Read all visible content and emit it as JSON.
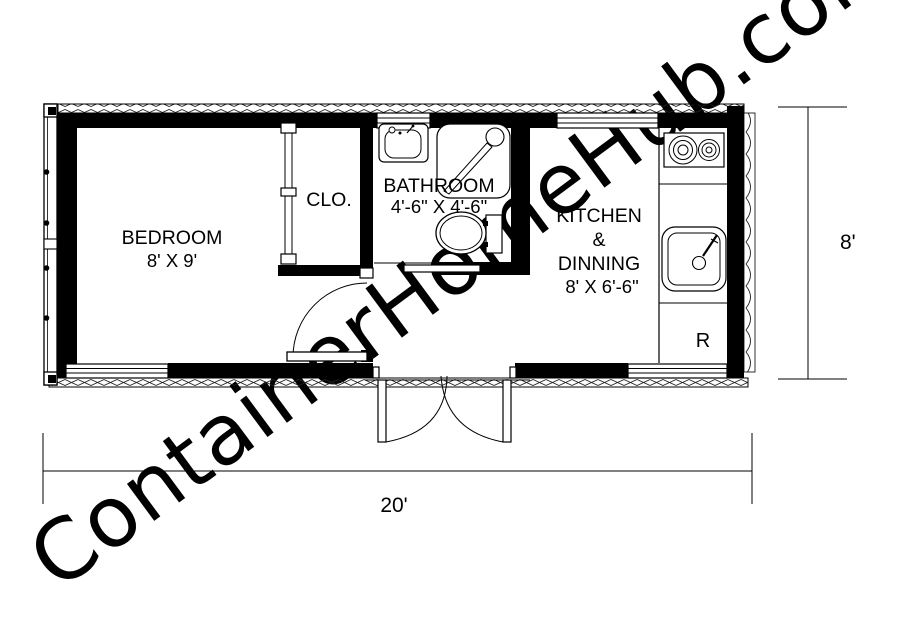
{
  "watermark": {
    "text": "ContainerHomeHub.com",
    "color": "#e3e3e3"
  },
  "rooms": {
    "bedroom": {
      "label": "BEDROOM",
      "size": "8' X 9'"
    },
    "closet": {
      "label": "CLO."
    },
    "bathroom": {
      "label": "BATHROOM",
      "size": "4'-6\" X 4'-6\""
    },
    "kitchen_dining": {
      "label_line1": "KITCHEN",
      "label_line2": "&",
      "label_line3": "DINNING",
      "size": "8' X 6'-6\""
    }
  },
  "appliances": {
    "refrigerator_label": "R"
  },
  "dimensions": {
    "overall_length": "20'",
    "overall_width": "8'"
  },
  "fixtures": [
    "container-end-doors",
    "corrugated-wall",
    "bedroom-window",
    "closet-doors",
    "bedroom-door",
    "bathroom-sink",
    "shower",
    "toilet",
    "bathroom-sliding-door",
    "bathroom-window",
    "kitchen-window",
    "stove",
    "kitchen-sink",
    "refrigerator-space",
    "double-entry-door",
    "kitchen-rear-window"
  ],
  "colors": {
    "line": "#000000",
    "background": "#ffffff"
  }
}
